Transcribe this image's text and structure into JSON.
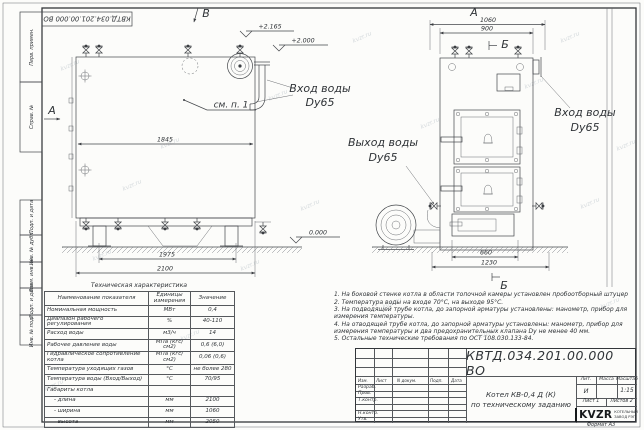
{
  "frame": {
    "top_stamp": "КВТД.034.201.00.000 ВО",
    "format_label": "Формат А3",
    "left_labels": [
      "Перв. примен.",
      "Справ. №",
      "Подп. и дата",
      "Инв. № дубл.",
      "Взам. инв. №",
      "Подп. и дата",
      "Инв. № подл."
    ]
  },
  "watermark": {
    "text": "kvzr.ru"
  },
  "side_view": {
    "view_arrow": "В",
    "direction_label": "А",
    "dim_inner_width": "1845",
    "dim_support_span": "1975",
    "dim_length": "2100",
    "elevation_top": "+2.165",
    "elevation_mid": "+2.000",
    "elevation_ground": "0.000",
    "callout": "см. п. 1",
    "inlet_line1": "Вход воды",
    "inlet_line2": "Dy65"
  },
  "front_view": {
    "view_label": "А",
    "section_label_top": "Б",
    "section_label_bottom": "Б",
    "dim_width": "1060",
    "dim_inner_width": "900",
    "dim_base": "660",
    "dim_overall": "1230",
    "inlet_line1": "Вход воды",
    "inlet_line2": "Dy65",
    "outlet_line1": "Выход воды",
    "outlet_line2": "Dy65"
  },
  "spec_table": {
    "title": "Техническая характеристика",
    "headers": [
      "Наименование показателя",
      "Единицы измерения",
      "Значение"
    ],
    "rows": [
      [
        "Номинальная мощность",
        "МВт",
        "0,4"
      ],
      [
        "Диапазон рабочего регулирования",
        "%",
        "40-110"
      ],
      [
        "Расход воды",
        "м3/ч",
        "14"
      ],
      [
        "Рабочее давление воды",
        "МПа (кгс/см2)",
        "0,6 (6,0)"
      ],
      [
        "Гидравлическое сопротивление котла",
        "МПа (кгс/см2)",
        "0,06 (0,6)"
      ],
      [
        "Температура уходящих газов",
        "°С",
        "не более 280"
      ],
      [
        "Температура воды (Вход/Выход)",
        "°С",
        "70/95"
      ],
      [
        "Габариты котла",
        "",
        ""
      ],
      [
        "- длина",
        "мм",
        "2100"
      ],
      [
        "- ширина",
        "мм",
        "1060"
      ],
      [
        "- высота",
        "мм",
        "2050"
      ]
    ]
  },
  "notes": [
    "1. На боковой стенке котла в области топочной камеры установлен пробоотборный штуцер",
    "2. Температура воды на входе 70°С, на выходе 95°С.",
    "3. На подводящей трубе котла, до запорной арматуры установлены: манометр, прибор для измерения температуры.",
    "4. На отводящей трубе котла, до запорной арматуры установлены: манометр, прибор для измерения температуры и два предохранительных клапана Dу не менее 40 мм.",
    "5. Остальные технические требования по ОСТ 108.030.133-84."
  ],
  "title_block": {
    "doc_number": "КВТД.034.201.00.000 ВО",
    "title_line1": "Котел КВ-0,4 Д (К)",
    "title_line2": "по техническому заданию",
    "header_cols": [
      "Изм.",
      "Лист",
      "N докум.",
      "Подп.",
      "Дата"
    ],
    "row_labels": [
      "Разраб.",
      "Пров.",
      "Т.контр.",
      "Н.контр.",
      "Утв."
    ],
    "lit_header": "Лит.",
    "mass_header": "Масса",
    "scale_header": "Масштаб",
    "lit_value": "И",
    "scale_value": "1:15",
    "sheet_label": "Лист 1",
    "sheets_label": "Листов 2",
    "logo_text": "KVZR",
    "company_line1": "КОТЕЛЬНЫЙ",
    "company_line2": "ЗАВОД РЭП"
  }
}
